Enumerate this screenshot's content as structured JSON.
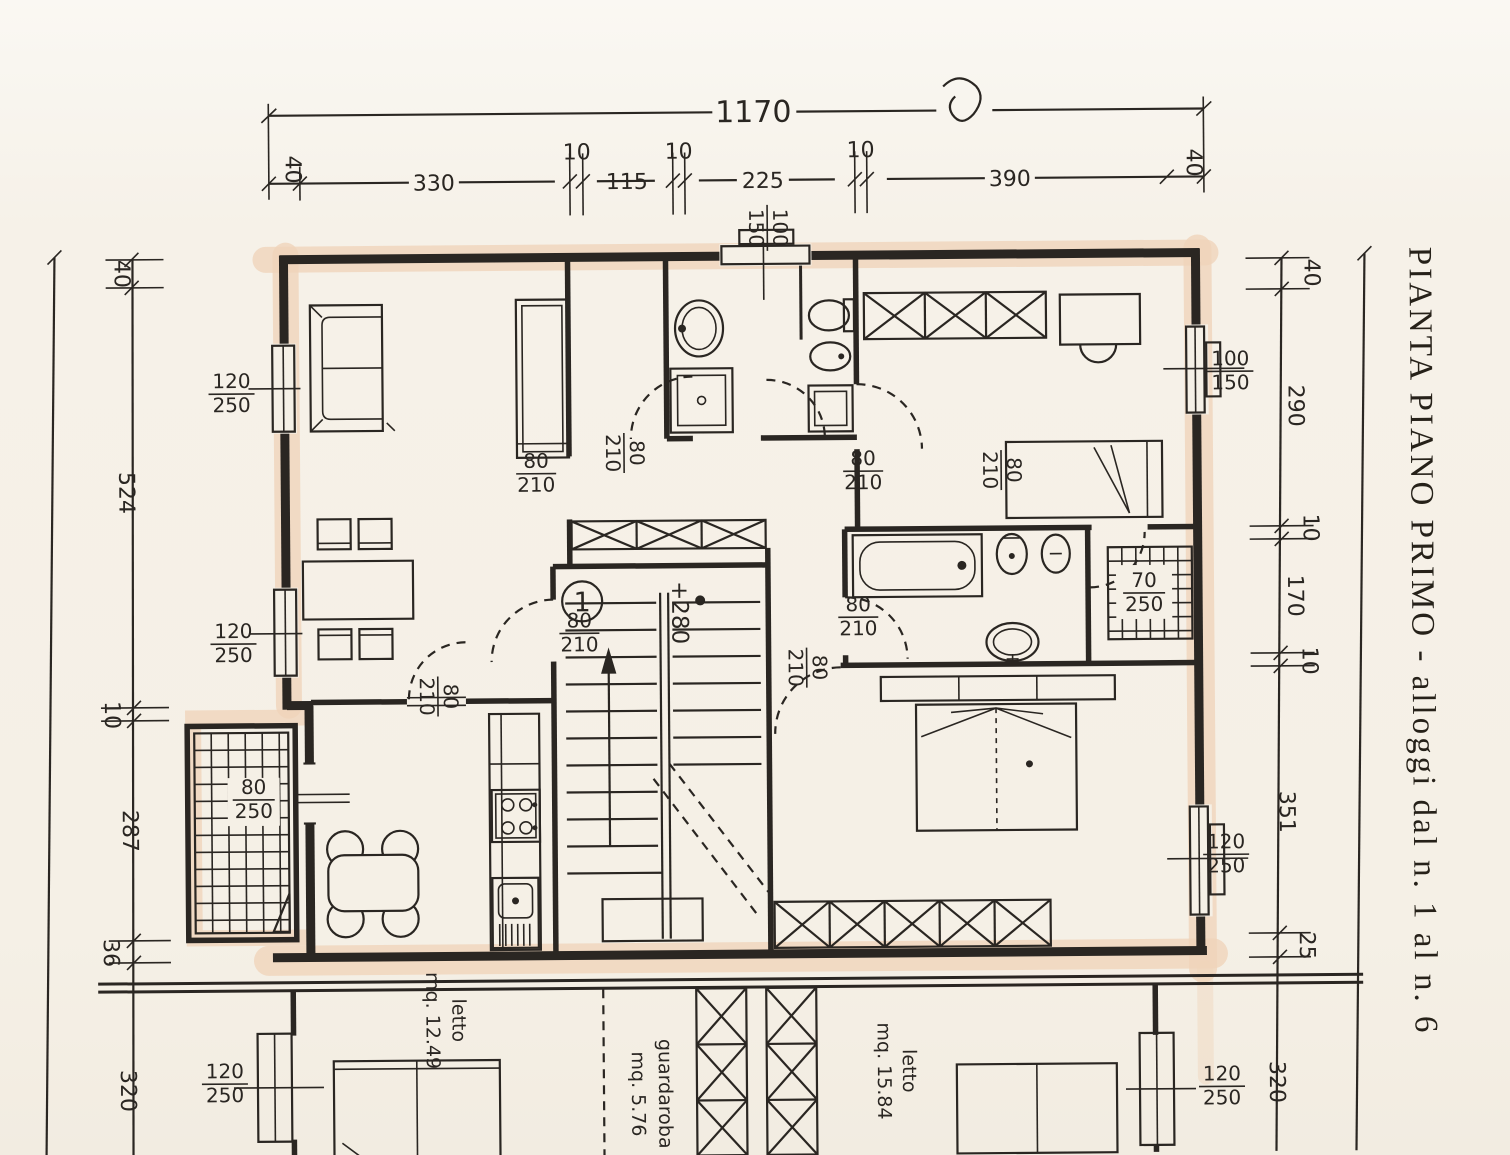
{
  "title": "PIANTA PIANO PRIMO  -  alloggi dal n. 1 al n. 6",
  "dims": {
    "top_total": "1170",
    "top": [
      "40",
      "330",
      "10",
      "115",
      "10",
      "225",
      "10",
      "390",
      "40"
    ],
    "left": [
      "40",
      "524",
      "10",
      "287",
      "36",
      "320"
    ],
    "right": [
      "40",
      "290",
      "10",
      "170",
      "10",
      "351",
      "25",
      "320"
    ]
  },
  "windows": [
    {
      "num": "100",
      "den": "150"
    },
    {
      "num": "120",
      "den": "250"
    },
    {
      "num": "120",
      "den": "250"
    },
    {
      "num": "80",
      "den": "250"
    },
    {
      "num": "120",
      "den": "250"
    },
    {
      "num": "100",
      "den": "150"
    },
    {
      "num": "70",
      "den": "250"
    },
    {
      "num": "120",
      "den": "250"
    },
    {
      "num": "120",
      "den": "250"
    }
  ],
  "doors": [
    {
      "num": "80",
      "den": "210"
    },
    {
      "num": "80",
      "den": "210"
    },
    {
      "num": "80",
      "den": "210"
    },
    {
      "num": "80",
      "den": "210"
    },
    {
      "num": "80",
      "den": "210"
    },
    {
      "num": "80",
      "den": "210"
    },
    {
      "num": "80",
      "den": "210"
    },
    {
      "num": "80",
      "den": "210"
    }
  ],
  "rooms": [
    {
      "name": "letto",
      "area": "mq. 12.49"
    },
    {
      "name": "guardaroba",
      "area": "mq. 5.76"
    },
    {
      "name": "letto",
      "area": "mq. 15.84"
    }
  ],
  "stair": {
    "unit": "1",
    "level": "+280"
  },
  "colors": {
    "paper": "#f5f0e6",
    "ink": "#2a2622",
    "highlight": "#f0d4ba"
  }
}
